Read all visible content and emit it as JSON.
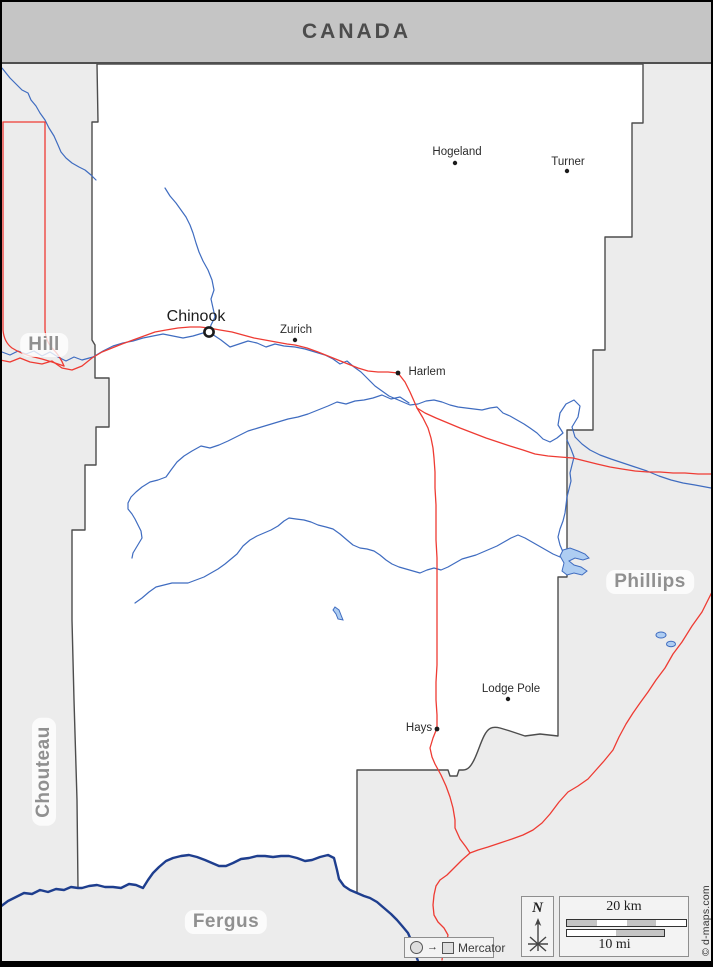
{
  "banner": {
    "title": "CANADA"
  },
  "map": {
    "county_shown": "Blaine County, Montana",
    "neighbor_counties": [
      {
        "name": "Hill"
      },
      {
        "name": "Phillips"
      },
      {
        "name": "Chouteau"
      },
      {
        "name": "Fergus"
      }
    ],
    "towns": [
      {
        "name": "Chinook",
        "type": "county-seat"
      },
      {
        "name": "Zurich",
        "type": "town"
      },
      {
        "name": "Harlem",
        "type": "town"
      },
      {
        "name": "Hogeland",
        "type": "town"
      },
      {
        "name": "Turner",
        "type": "town"
      },
      {
        "name": "Lodge Pole",
        "type": "town"
      },
      {
        "name": "Hays",
        "type": "town"
      }
    ]
  },
  "legend": {
    "projection": "Mercator",
    "compass": "N",
    "scale_km": "20 km",
    "scale_mi": "10 mi"
  },
  "copyright": "© d-maps.com",
  "colors": {
    "outside_fill": "#ececec",
    "county_fill": "#ffffff",
    "border": "#4d4d4d",
    "river": "#3f6cc0",
    "major_river": "#1e3e8e",
    "road": "#ee3b33",
    "banner_bg": "#c5c5c5",
    "county_label": "#909090"
  }
}
